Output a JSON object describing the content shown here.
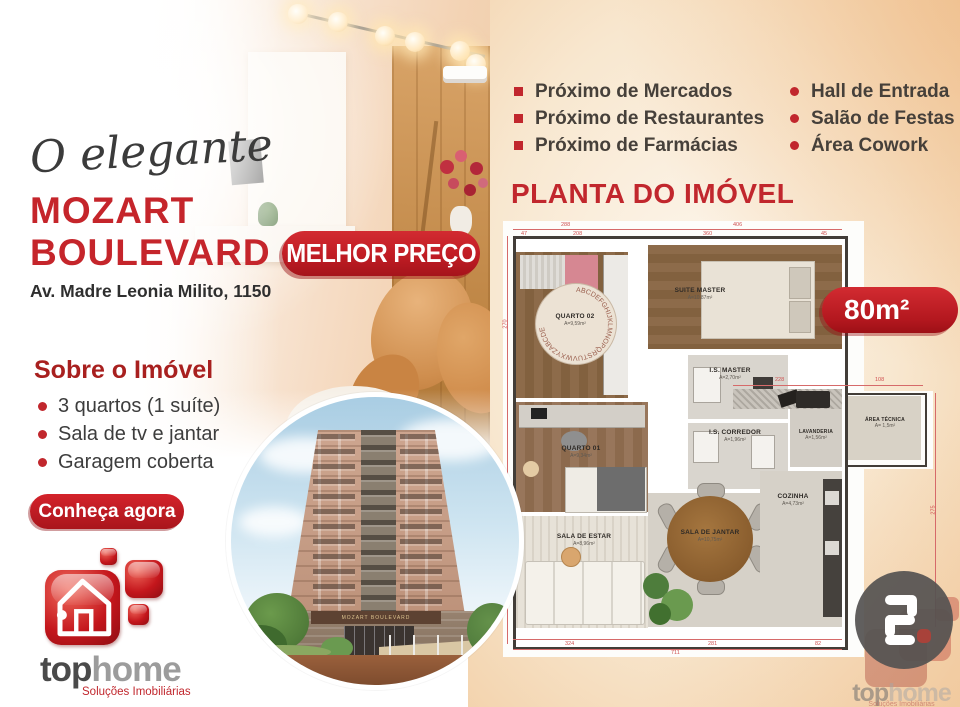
{
  "header": {
    "tagline": "O elegante",
    "title1": "MOZART",
    "title2": "BOULEVARD",
    "address": "Av. Madre Leonia Milito, 1150",
    "price_badge": "MELHOR PREÇO"
  },
  "about": {
    "heading": "Sobre o Imóvel",
    "items": [
      "3 quartos (1 suíte)",
      "Sala de tv e jantar",
      "Garagem coberta"
    ],
    "cta": "Conheça agora"
  },
  "features": {
    "left": [
      "Próximo de Mercados",
      "Próximo de Restaurantes",
      "Próximo de Farmácias"
    ],
    "right": [
      "Hall de Entrada",
      "Salão de Festas",
      "Área Cowork"
    ]
  },
  "plan": {
    "heading": "PLANTA DO IMÓVEL",
    "area_badge": "80m²",
    "rug_letters": "ABCDEFGHIJKLMNOPQRSTUVWXYZABCDE",
    "rooms": [
      {
        "name": "QUARTO 02",
        "area": "A=9,59m²"
      },
      {
        "name": "SUITE MASTER",
        "area": "A=10,87m²"
      },
      {
        "name": "I.S. MASTER",
        "area": "A=2,70m²"
      },
      {
        "name": "I.S. CORREDOR",
        "area": "A=1,96m²"
      },
      {
        "name": "QUARTO 01",
        "area": "A=9,34m²"
      },
      {
        "name": "SALA DE ESTAR",
        "area": "A=8,96m²"
      },
      {
        "name": "SALA DE JANTAR",
        "area": "A=10,75m²"
      },
      {
        "name": "COZINHA",
        "area": "A=4,73m²"
      },
      {
        "name": "LAVANDERIA",
        "area": "A=1,56m²"
      },
      {
        "name": "ÁREA TÉCNICA",
        "area": "A= 1,5m²"
      }
    ],
    "dims": {
      "t1": "288",
      "t2": "406",
      "t1a": "47",
      "t1b": "208",
      "t2a": "360",
      "t2b": "45",
      "l1": "270",
      "l2": "273",
      "b1": "324",
      "b2": "281",
      "b3": "82",
      "b4": "711",
      "r1": "275",
      "e1": "228",
      "e2": "108"
    }
  },
  "building": {
    "sign": "MOZART BOULEVARD"
  },
  "logo": {
    "top": "top",
    "home": "home",
    "subtitle": "Soluções Imobiliárias"
  },
  "colors": {
    "red": "#c1272d",
    "dark_red": "#a8201f",
    "badge_red": "#c8202a",
    "peach": "#f2cfa6",
    "text": "#46403a"
  }
}
